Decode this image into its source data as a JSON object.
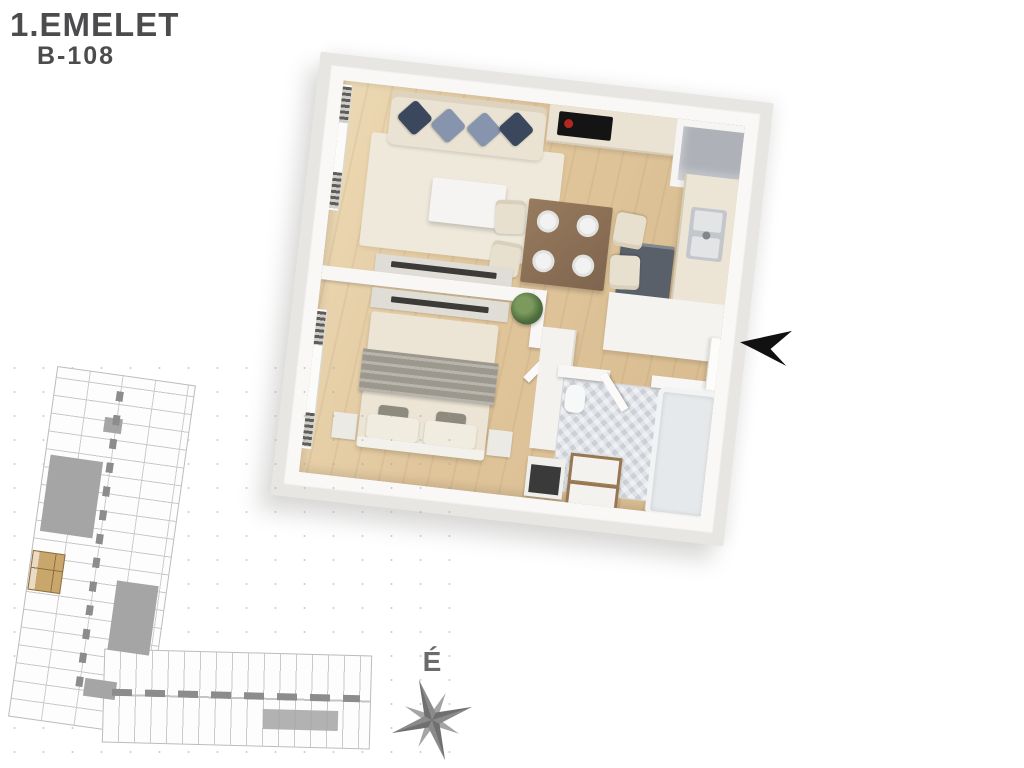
{
  "header": {
    "floor_label": "1.EMELET",
    "unit_label": "B-108"
  },
  "compass": {
    "north_label": "É"
  },
  "icons": {
    "entrance_arrow": "left-pointing-dart",
    "compass_rose": "eight-point-star"
  },
  "colors": {
    "title_text": "#4c4c4e",
    "wood_floor": "#e0c59b",
    "wall_white": "#f9f8f6",
    "plate_gray": "#e8e6e2",
    "pillow_navy": "#3b475c",
    "pillow_slate": "#8695ad",
    "appliance_dark": "#596069",
    "cooktop_black": "#141414",
    "cooktop_burner_red": "#b3271e",
    "dining_table_wood": "#8b7157",
    "bath_tile_gray": "#ccd0d6",
    "site_outline_gray": "#bcbcbc",
    "site_courtyard_gray": "#a5a5a5",
    "highlight_unit_tan": "#c9a66b",
    "arrow_black": "#111111",
    "compass_gray": "#8a8a8a"
  }
}
